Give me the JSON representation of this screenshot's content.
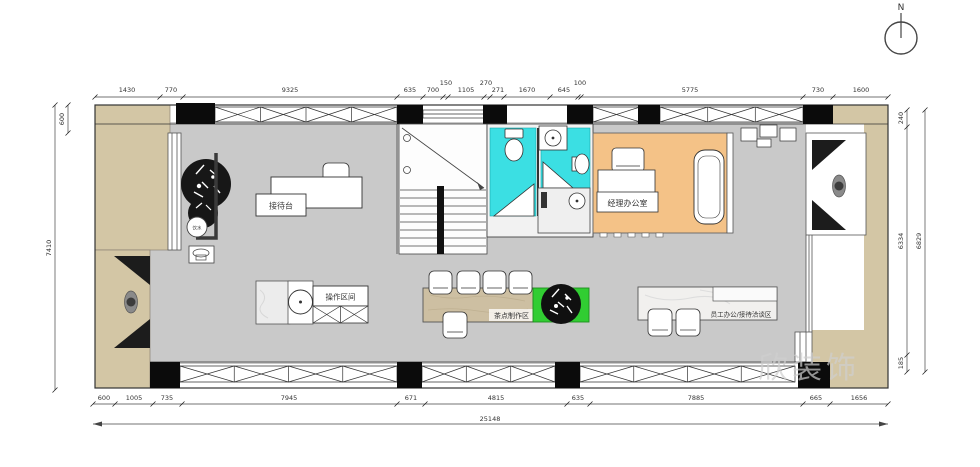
{
  "compass": {
    "north_label": "N"
  },
  "watermark": {
    "text": "欣装饰"
  },
  "rooms": {
    "reception_desk_label": "接待台",
    "operation_area_label": "操作区间",
    "tea_bar_label": "茶点制作区",
    "staff_office_label": "员工办公/接待洽谈区",
    "manager_office_label": "经理办公室",
    "water_dispenser_label": "饮水"
  },
  "dimensions": {
    "top": [
      "1430",
      "770",
      "9325",
      "635",
      "700",
      "150",
      "1105",
      "270",
      "271",
      "1670",
      "645",
      "100",
      "5775",
      "730",
      "1600"
    ],
    "bottom": [
      "600",
      "1005",
      "735",
      "7945",
      "671",
      "4815",
      "635",
      "7885",
      "665",
      "1656"
    ],
    "bottom_total": "25148",
    "left": {
      "offset": "600",
      "total": "7410"
    },
    "right": {
      "segments": [
        "240",
        "6334",
        "185"
      ],
      "total": "6829"
    }
  }
}
